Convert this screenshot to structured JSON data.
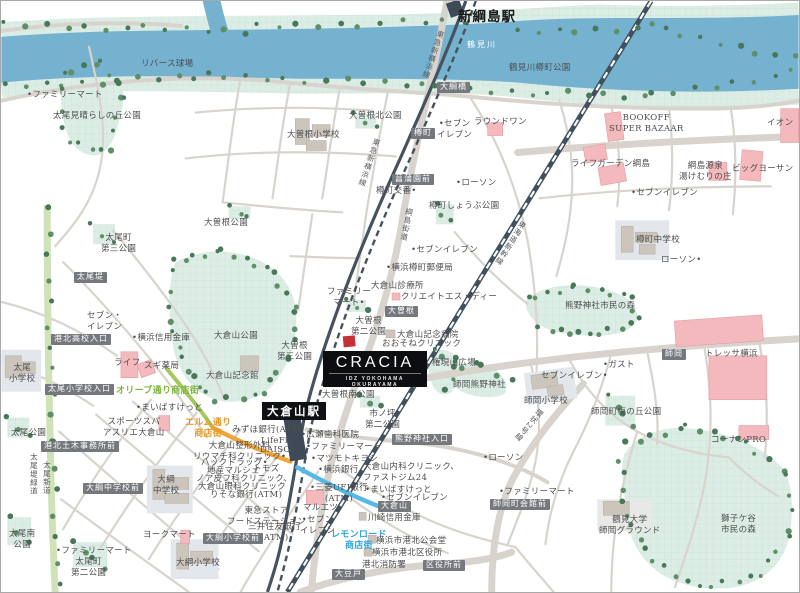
{
  "property": {
    "name": "CRACIA",
    "subtitle": "IDZ YOKOHAMA OKURAYAMA"
  },
  "map": {
    "colors": {
      "river": "#74b2d0",
      "park": "#dcede5",
      "park_grid": "#cbe2d7",
      "road": "#d8d4cd",
      "rail": "#46525e",
      "shinkansen": "#41505d",
      "street_orange": "#f0a43c",
      "street_blue": "#56b8e6",
      "street_green": "#a4c85e",
      "greenway": "#cfe2b8",
      "building_commercial": "#f3b9bd",
      "building_public": "#ccc5bc",
      "property_marker": "#c5303a",
      "poi_label_bg": "#75787c"
    },
    "stations": [
      {
        "label": "新綱島駅"
      },
      {
        "label": "大倉山駅"
      }
    ],
    "rail_lines": [
      "東急新横浜線",
      "東海道新幹線"
    ],
    "streets": [
      "綱島街道",
      "環状2号線",
      "太尾堤緑道",
      "太尾新道",
      "オリーブ通り商店街",
      "エルム通り商店街",
      "レモンロード商店街"
    ],
    "labels": [
      {
        "t": "リバース球場",
        "x": 140,
        "y": 58,
        "c": "p"
      },
      {
        "t": "•ファミリーマート",
        "x": 26,
        "y": 89,
        "c": "p"
      },
      {
        "t": "太尾見晴らしの丘公園",
        "x": 52,
        "y": 110,
        "c": "p"
      },
      {
        "t": "鶴見川",
        "x": 466,
        "y": 39,
        "c": "w",
        "n": "river-name"
      },
      {
        "t": "鶴見川樽町公園",
        "x": 508,
        "y": 62,
        "c": "p"
      },
      {
        "t": "新綱島駅",
        "x": 457,
        "y": 8,
        "c": "st",
        "n": "station-shin-tsunashima"
      },
      {
        "t": "大綱橋",
        "x": 436,
        "y": 81,
        "c": "d"
      },
      {
        "t": "大曽根北公園",
        "x": 348,
        "y": 110,
        "c": "p"
      },
      {
        "t": "大曽根小学校",
        "x": 286,
        "y": 129,
        "c": "p"
      },
      {
        "t": "•セブン\nイレブン",
        "x": 436,
        "y": 118,
        "c": "p ctr"
      },
      {
        "t": "ラウンドワン",
        "x": 473,
        "y": 116,
        "c": "p"
      },
      {
        "t": "BOOKOFF\nSUPER BAZAAR",
        "x": 608,
        "y": 112,
        "c": "p ctr"
      },
      {
        "t": "イオン",
        "x": 766,
        "y": 117,
        "c": "p"
      },
      {
        "t": "ライフガーデン綱島",
        "x": 570,
        "y": 158,
        "c": "p"
      },
      {
        "t": "綱島源泉\n湯けむりの庄",
        "x": 678,
        "y": 160,
        "c": "p ctr"
      },
      {
        "t": "ビッグヨーサン",
        "x": 731,
        "y": 163,
        "c": "p"
      },
      {
        "t": "•セブンイレブン",
        "x": 630,
        "y": 187,
        "c": "p"
      },
      {
        "t": "樽町",
        "x": 410,
        "y": 127,
        "c": "d"
      },
      {
        "t": "菖蒲園前",
        "x": 391,
        "y": 173,
        "c": "d"
      },
      {
        "t": "樽町交番•",
        "x": 375,
        "y": 185,
        "c": "p"
      },
      {
        "t": "•ローソン",
        "x": 455,
        "y": 177,
        "c": "p"
      },
      {
        "t": "樽町しょうぶ公園",
        "x": 428,
        "y": 200,
        "c": "p"
      },
      {
        "t": "東急新横浜線",
        "x": 436,
        "y": 28,
        "c": "v",
        "r": 19,
        "n": "rail-label-shin-yokohama-line"
      },
      {
        "t": "東急新横浜線",
        "x": 372,
        "y": 136,
        "c": "v",
        "r": 19,
        "n": "rail-label-shin-yokohama-line"
      },
      {
        "t": "綱島街道",
        "x": 404,
        "y": 206,
        "c": "v",
        "r": 11,
        "n": "road-label-tsunashima-kaido"
      },
      {
        "t": "太尾町\n第三公園",
        "x": 100,
        "y": 232,
        "c": "p ctr"
      },
      {
        "t": "大曽根公園",
        "x": 203,
        "y": 217,
        "c": "p"
      },
      {
        "t": "太尾堤",
        "x": 73,
        "y": 271,
        "c": "d"
      },
      {
        "t": "•セブンイレブン",
        "x": 410,
        "y": 244,
        "c": "p"
      },
      {
        "t": "•横浜樽町郵便局",
        "x": 385,
        "y": 262,
        "c": "p"
      },
      {
        "t": "大倉山診療所",
        "x": 370,
        "y": 280,
        "c": "p"
      },
      {
        "t": "クリエイトエス・ディー",
        "x": 400,
        "y": 291,
        "c": "p"
      },
      {
        "t": "樽町中学校",
        "x": 635,
        "y": 234,
        "c": "p"
      },
      {
        "t": "ローソン•",
        "x": 660,
        "y": 254,
        "c": "p"
      },
      {
        "t": "東海道新幹線",
        "x": 519,
        "y": 218,
        "c": "v",
        "r": 32,
        "n": "rail-label-tokaido-shinkansen"
      },
      {
        "t": "セブン・\nイレブン",
        "x": 86,
        "y": 310,
        "c": "p ctr"
      },
      {
        "t": "•横浜信用金庫",
        "x": 131,
        "y": 332,
        "c": "p"
      },
      {
        "t": "大倉山公園",
        "x": 213,
        "y": 330,
        "c": "p"
      },
      {
        "t": "熊野神社市民の森",
        "x": 564,
        "y": 300,
        "c": "p"
      },
      {
        "t": "港北高校入口",
        "x": 50,
        "y": 333,
        "c": "d"
      },
      {
        "t": "ファミリー\nマート•",
        "x": 326,
        "y": 286,
        "c": "p ctr"
      },
      {
        "t": "大曽根",
        "x": 384,
        "y": 305,
        "c": "d"
      },
      {
        "t": "大曽根\n第二公園",
        "x": 350,
        "y": 315,
        "c": "p ctr"
      },
      {
        "t": "大曽根\n第三公園",
        "x": 276,
        "y": 340,
        "c": "p ctr"
      },
      {
        "t": "大倉山記念病院",
        "x": 396,
        "y": 329,
        "c": "p"
      },
      {
        "t": "おおそねクリニック",
        "x": 381,
        "y": 338,
        "c": "p"
      },
      {
        "t": "ライフ",
        "x": 113,
        "y": 357,
        "c": "p"
      },
      {
        "t": "スギ薬局",
        "x": 143,
        "y": 360,
        "c": "p"
      },
      {
        "t": "大倉山記念館",
        "x": 205,
        "y": 370,
        "c": "p"
      },
      {
        "t": "権現山広場",
        "x": 431,
        "y": 357,
        "c": "p"
      },
      {
        "t": "師岡熊野神社",
        "x": 452,
        "y": 379,
        "c": "p"
      },
      {
        "t": "大曽根南公園",
        "x": 321,
        "y": 389,
        "c": "p"
      },
      {
        "t": "太尾小学校入口",
        "x": 44,
        "y": 383,
        "c": "d"
      },
      {
        "t": "太尾\n小学校",
        "x": 8,
        "y": 362,
        "c": "p ctr"
      },
      {
        "t": "オリーブ通り商店街",
        "x": 115,
        "y": 385,
        "c": "g",
        "n": "street-label-olive-dori"
      },
      {
        "t": "トレッサ横浜",
        "x": 704,
        "y": 348,
        "c": "p"
      },
      {
        "t": "師岡",
        "x": 661,
        "y": 348,
        "c": "d"
      },
      {
        "t": "•ガスト",
        "x": 602,
        "y": 359,
        "c": "p"
      },
      {
        "t": "セブンイレブン•",
        "x": 540,
        "y": 370,
        "c": "p"
      },
      {
        "t": "師岡小学校",
        "x": 523,
        "y": 395,
        "c": "p"
      },
      {
        "t": "師岡町梅の丘公園",
        "x": 590,
        "y": 406,
        "c": "p"
      },
      {
        "t": "コーナンPRO",
        "x": 710,
        "y": 434,
        "c": "p"
      },
      {
        "t": "環状2号線",
        "x": 537,
        "y": 406,
        "c": "v",
        "r": 40,
        "n": "road-label-kanjo-2"
      },
      {
        "t": "•まいばすけっと",
        "x": 135,
        "y": 402,
        "c": "p"
      },
      {
        "t": "スポーツスパ\nアスリエ大倉山",
        "x": 102,
        "y": 416,
        "c": "p ctr"
      },
      {
        "t": "太尾公園",
        "x": 10,
        "y": 427,
        "c": "p"
      },
      {
        "t": "港北土木事務所前",
        "x": 40,
        "y": 440,
        "c": "d"
      },
      {
        "t": "エルム通り\n商店街",
        "x": 184,
        "y": 417,
        "c": "o ctr",
        "n": "street-label-elm-dori"
      },
      {
        "t": "みずほ銀行(ATM)",
        "x": 231,
        "y": 424,
        "c": "p"
      },
      {
        "t": "LifeFit.",
        "x": 260,
        "y": 435,
        "c": "p"
      },
      {
        "t": "DAISO•",
        "x": 259,
        "y": 444,
        "c": "p"
      },
      {
        "t": "大倉山整形外科\nリウマチ科クリニック•",
        "x": 192,
        "y": 440,
        "c": "p ctr"
      },
      {
        "t": "ハックドラッグ•",
        "x": 200,
        "y": 457,
        "c": "p"
      },
      {
        "t": "地産マルシェ",
        "x": 206,
        "y": 465,
        "c": "p"
      },
      {
        "t": "トモズ",
        "x": 252,
        "y": 463,
        "c": "p"
      },
      {
        "t": "ノア皮フ科クリニック、",
        "x": 195,
        "y": 473,
        "c": "p"
      },
      {
        "t": "大倉山眼科クリニック",
        "x": 197,
        "y": 481,
        "c": "p"
      },
      {
        "t": "りそな銀行(ATM)",
        "x": 209,
        "y": 489,
        "c": "p"
      },
      {
        "t": "東急ストア\nフードステーション",
        "x": 226,
        "y": 505,
        "c": "p ctr"
      },
      {
        "t": "三井住友銀行\n(ATM)",
        "x": 247,
        "y": 521,
        "c": "p ctr"
      },
      {
        "t": "大倉山駅",
        "x": 261,
        "y": 401,
        "c": "sb",
        "n": "station-okurayama"
      },
      {
        "t": "•広瀬歯科医院",
        "x": 300,
        "y": 429,
        "c": "p"
      },
      {
        "t": "•ファミリーマート",
        "x": 305,
        "y": 441,
        "c": "p"
      },
      {
        "t": "•マツモトキヨシ",
        "x": 310,
        "y": 453,
        "c": "p"
      },
      {
        "t": "•横浜銀行",
        "x": 317,
        "y": 464,
        "c": "p"
      },
      {
        "t": "市ノ坪\n第二公園",
        "x": 364,
        "y": 408,
        "c": "p ctr"
      },
      {
        "t": "熊野神社入口",
        "x": 391,
        "y": 433,
        "c": "d"
      },
      {
        "t": "•ローソン",
        "x": 482,
        "y": 452,
        "c": "p"
      },
      {
        "t": "•ファミリーマート",
        "x": 498,
        "y": 486,
        "c": "p"
      },
      {
        "t": "師岡町会館前",
        "x": 489,
        "y": 498,
        "c": "d"
      },
      {
        "t": "大倉山内科クリニック、\nファストジム24",
        "x": 362,
        "y": 461,
        "c": "p"
      },
      {
        "t": "•まいばすけっと",
        "x": 364,
        "y": 484,
        "c": "p"
      },
      {
        "t": "•セブンイレブン",
        "x": 380,
        "y": 492,
        "c": "p"
      },
      {
        "t": "大倉山",
        "x": 377,
        "y": 500,
        "c": "d"
      },
      {
        "t": "川崎信用金庫",
        "x": 367,
        "y": 512,
        "c": "p"
      },
      {
        "t": "•三菱UFJ銀行\n(ATM)",
        "x": 309,
        "y": 482,
        "c": "p ctr"
      },
      {
        "t": "マルエツ",
        "x": 302,
        "y": 502,
        "c": "p"
      },
      {
        "t": "•セブン\nイレブン",
        "x": 299,
        "y": 514,
        "c": "p ctr"
      },
      {
        "t": "レモンロード\n商店街",
        "x": 330,
        "y": 529,
        "c": "b ctr",
        "n": "street-label-lemon-road"
      },
      {
        "t": "横浜市港北公会堂",
        "x": 375,
        "y": 535,
        "c": "p"
      },
      {
        "t": "横浜市港北区役所",
        "x": 371,
        "y": 547,
        "c": "p"
      },
      {
        "t": "港北消防署",
        "x": 361,
        "y": 559,
        "c": "p"
      },
      {
        "t": "区役所前",
        "x": 422,
        "y": 559,
        "c": "d"
      },
      {
        "t": "大豆戸",
        "x": 331,
        "y": 568,
        "c": "d"
      },
      {
        "t": "大綱中学校前",
        "x": 82,
        "y": 482,
        "c": "d"
      },
      {
        "t": "大綱\n中学校",
        "x": 152,
        "y": 474,
        "c": "p ctr"
      },
      {
        "t": "太尾堤緑道",
        "x": 28,
        "y": 452,
        "c": "v"
      },
      {
        "t": "太尾新道",
        "x": 41,
        "y": 460,
        "c": "v"
      },
      {
        "t": "太尾南\n公園",
        "x": 8,
        "y": 528,
        "c": "p ctr"
      },
      {
        "t": "•ファミリーマート",
        "x": 55,
        "y": 545,
        "c": "p"
      },
      {
        "t": "太尾町\n第二公園",
        "x": 70,
        "y": 556,
        "c": "p ctr"
      },
      {
        "t": "ヨークマート",
        "x": 142,
        "y": 529,
        "c": "p"
      },
      {
        "t": "大綱小学校前",
        "x": 202,
        "y": 532,
        "c": "d"
      },
      {
        "t": "大綱小学校",
        "x": 175,
        "y": 557,
        "c": "p"
      },
      {
        "t": "鶴見大学\n師岡グラウンド",
        "x": 598,
        "y": 514,
        "c": "p ctr"
      },
      {
        "t": "獅子ケ谷\n市民の森",
        "x": 720,
        "y": 513,
        "c": "p ctr"
      }
    ]
  }
}
